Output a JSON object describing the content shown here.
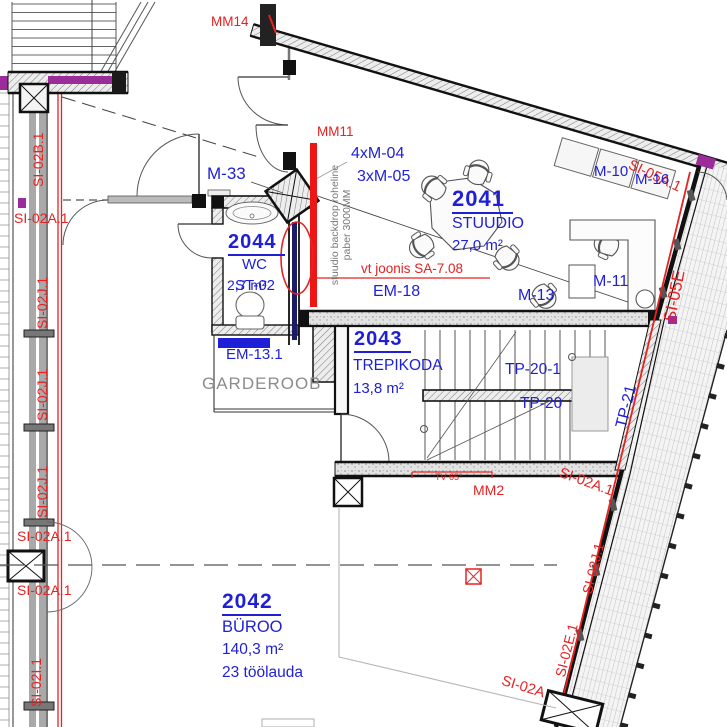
{
  "colors": {
    "blue": "#1f1fd6",
    "red": "#e62222",
    "gray": "#8c8c8c",
    "purple": "#9b2d9b",
    "backdrop_red": "#ee1515"
  },
  "rooms": {
    "studio": {
      "number": "2041",
      "name": "STUUDIO",
      "area": "27,0 m²"
    },
    "wc": {
      "number": "2044",
      "name": "WC",
      "area": "2,7 m²",
      "code": "ST-02"
    },
    "stair": {
      "number": "2043",
      "name": "TREPIKODA",
      "area": "13,8 m²"
    },
    "office": {
      "number": "2042",
      "name": "BÜROO",
      "area": "140,3 m²",
      "desks": "23 töölauda"
    },
    "cloak": {
      "name": "GARDEROOB"
    }
  },
  "marks": {
    "mm14": "MM14",
    "mm11": "MM11",
    "mm2": "MM2",
    "m33": "M-33",
    "m04": "4xM-04",
    "m05": "3xM-05",
    "m10": "M-10",
    "m16": "M-16",
    "m11": "M-11",
    "m13": "M-13",
    "em18": "EM-18",
    "em131": "EM-13.1",
    "tp201": "TP-20-1",
    "tp20": "TP-20",
    "tp21": "TP-21",
    "tv": "TV 65°",
    "vt": "vt joonis SA-7.08",
    "note1": "stuudio backdrop roheline",
    "note2": "paber 3000MM"
  },
  "si": {
    "b1": "SI-02B.1",
    "a1": "SI-02A.1",
    "j1": "SI-02J.1",
    "i1": "SI-02I.1",
    "e1": "SI-02E.1",
    "a": "SI-02A",
    "s05a": "SI-05A.1",
    "s05e": "SI-05E"
  }
}
